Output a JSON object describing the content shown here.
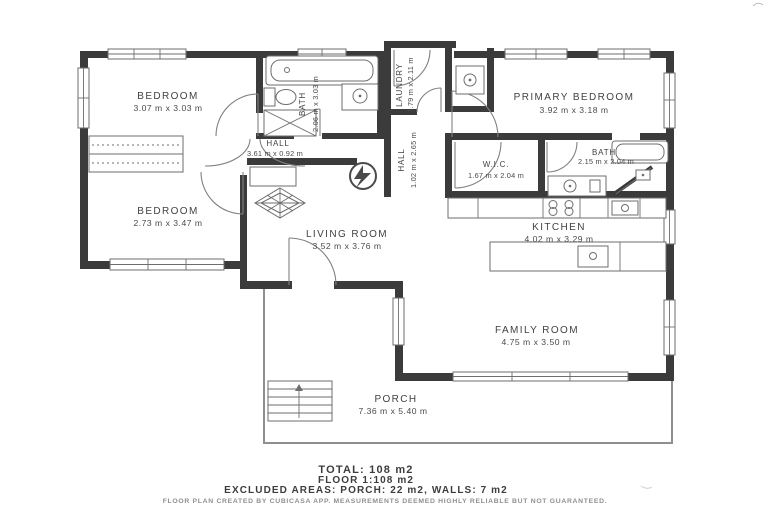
{
  "rooms": {
    "bedroom1": {
      "name": "BEDROOM",
      "dims": "3.07 m x 3.03 m"
    },
    "bath1": {
      "name": "BATH",
      "dims": "2.06 m x 3.03 m"
    },
    "laundry": {
      "name": "LAUNDRY",
      "dims": "1.79 m x 2.11 m"
    },
    "primary_bedroom": {
      "name": "PRIMARY BEDROOM",
      "dims": "3.92 m x 3.18 m"
    },
    "hall1": {
      "name": "HALL",
      "dims": "3.61 m x 0.92 m"
    },
    "hall2": {
      "name": "HALL",
      "dims": "1.02 m x 2.65 m"
    },
    "wic": {
      "name": "W.I.C.",
      "dims": "1.67 m x 2.04 m"
    },
    "bath2": {
      "name": "BATH",
      "dims": "2.15 m x 2.04 m"
    },
    "bedroom2": {
      "name": "BEDROOM",
      "dims": "2.73 m x 3.47 m"
    },
    "living_room": {
      "name": "LIVING ROOM",
      "dims": "3.52 m x 3.76 m"
    },
    "kitchen": {
      "name": "KITCHEN",
      "dims": "4.02 m x 3.29 m"
    },
    "family_room": {
      "name": "FAMILY ROOM",
      "dims": "4.75 m x 3.50 m"
    },
    "porch": {
      "name": "PORCH",
      "dims": "7.36 m x 5.40 m"
    }
  },
  "summary": {
    "total_line": "TOTAL: 108 m2",
    "floor_line": "FLOOR 1:108 m2",
    "excluded_line": "EXCLUDED AREAS: PORCH: 22 m2, WALLS: 7 m2",
    "disclaimer": "FLOOR PLAN CREATED BY CUBICASA APP. MEASUREMENTS DEEMED HIGHLY RELIABLE BUT NOT GUARANTEED."
  },
  "colors": {
    "wall": "#3b3b3b",
    "line": "#6e6e6e",
    "text": "#424242",
    "muted": "#8f8f8f"
  }
}
